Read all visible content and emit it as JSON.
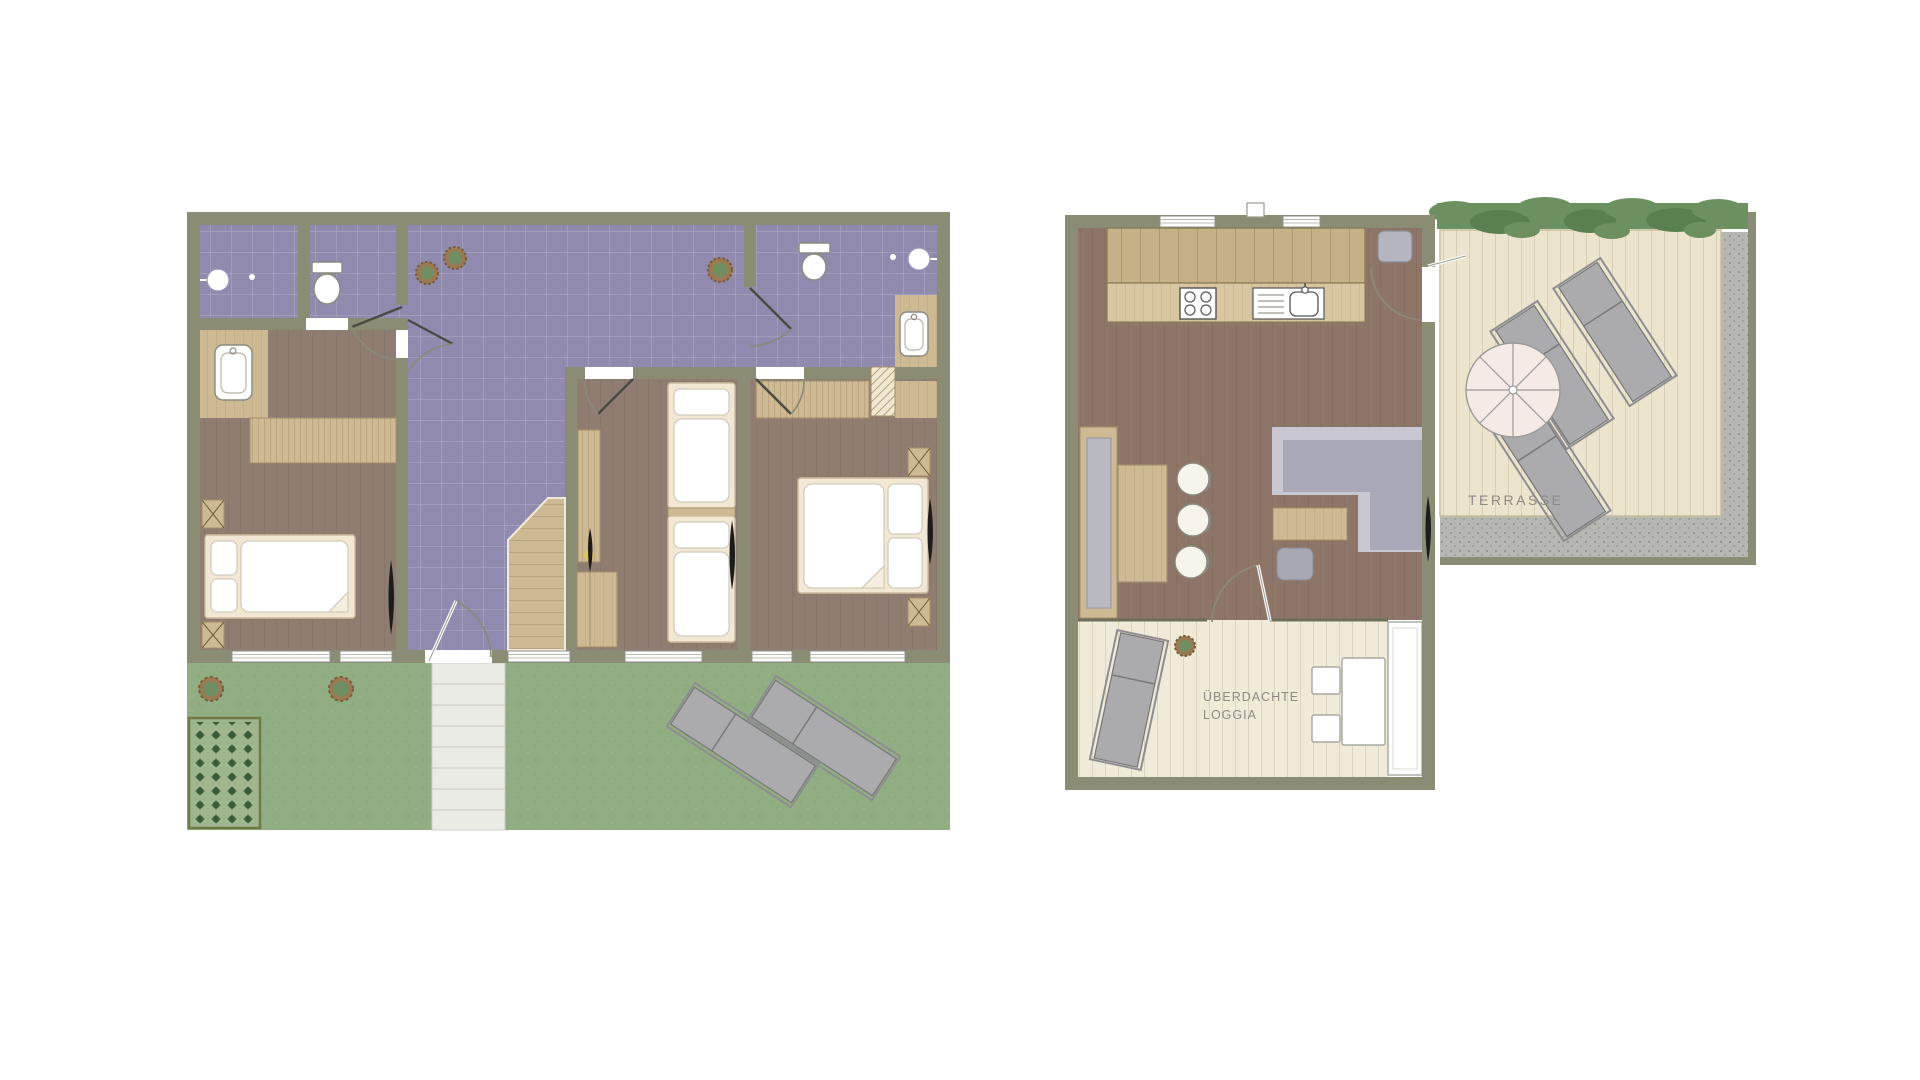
{
  "title": "apartment-floor-plans",
  "labels": {
    "terrasse": "TERRASSE",
    "loggia_line1": "ÜBERDACHTE",
    "loggia_line2": "LOGGIA"
  },
  "palette": {
    "wall": "#8b8c74",
    "wallEdge": "#6f705a",
    "tileFloor": "#8f8aae",
    "woodFloor": "#8e7d70",
    "mainFloor": "#8d7667",
    "lightWood": "#cdb992",
    "counterWood": "#d8c6a0",
    "cabinetWood": "#c6b088",
    "deckFloor": "#ece4cc",
    "loggiaFloor": "#f0ead9",
    "grass": "#91ae83",
    "gravel": "#b6b6b2",
    "hedge": "#6d9060",
    "hedgeDark": "#5b8050",
    "furnGray": "#ababae",
    "furnGrayDark": "#89898e",
    "sofaLight": "#c8c7d2",
    "sofaMid": "#a8a8b6",
    "bedFrame": "#f2e7d3",
    "bedFrameEdge": "#cdbc9e",
    "labelText": "#8b8b85",
    "doorArc": "#8a8a7a",
    "plantGreen": "#6e8f62",
    "mulchBrown": "#9a7a52",
    "accentYellow": "#ddc94f",
    "extStairs": "#ebebe5"
  },
  "symbols": {
    "double-bed": 2,
    "single-bed": 2,
    "toilet": 2,
    "shower": 2,
    "vanity-tub": 2,
    "sun-lounger": 6,
    "parasol": 1,
    "plant": 6,
    "stool": 3,
    "stove": 1,
    "sink": 1
  }
}
